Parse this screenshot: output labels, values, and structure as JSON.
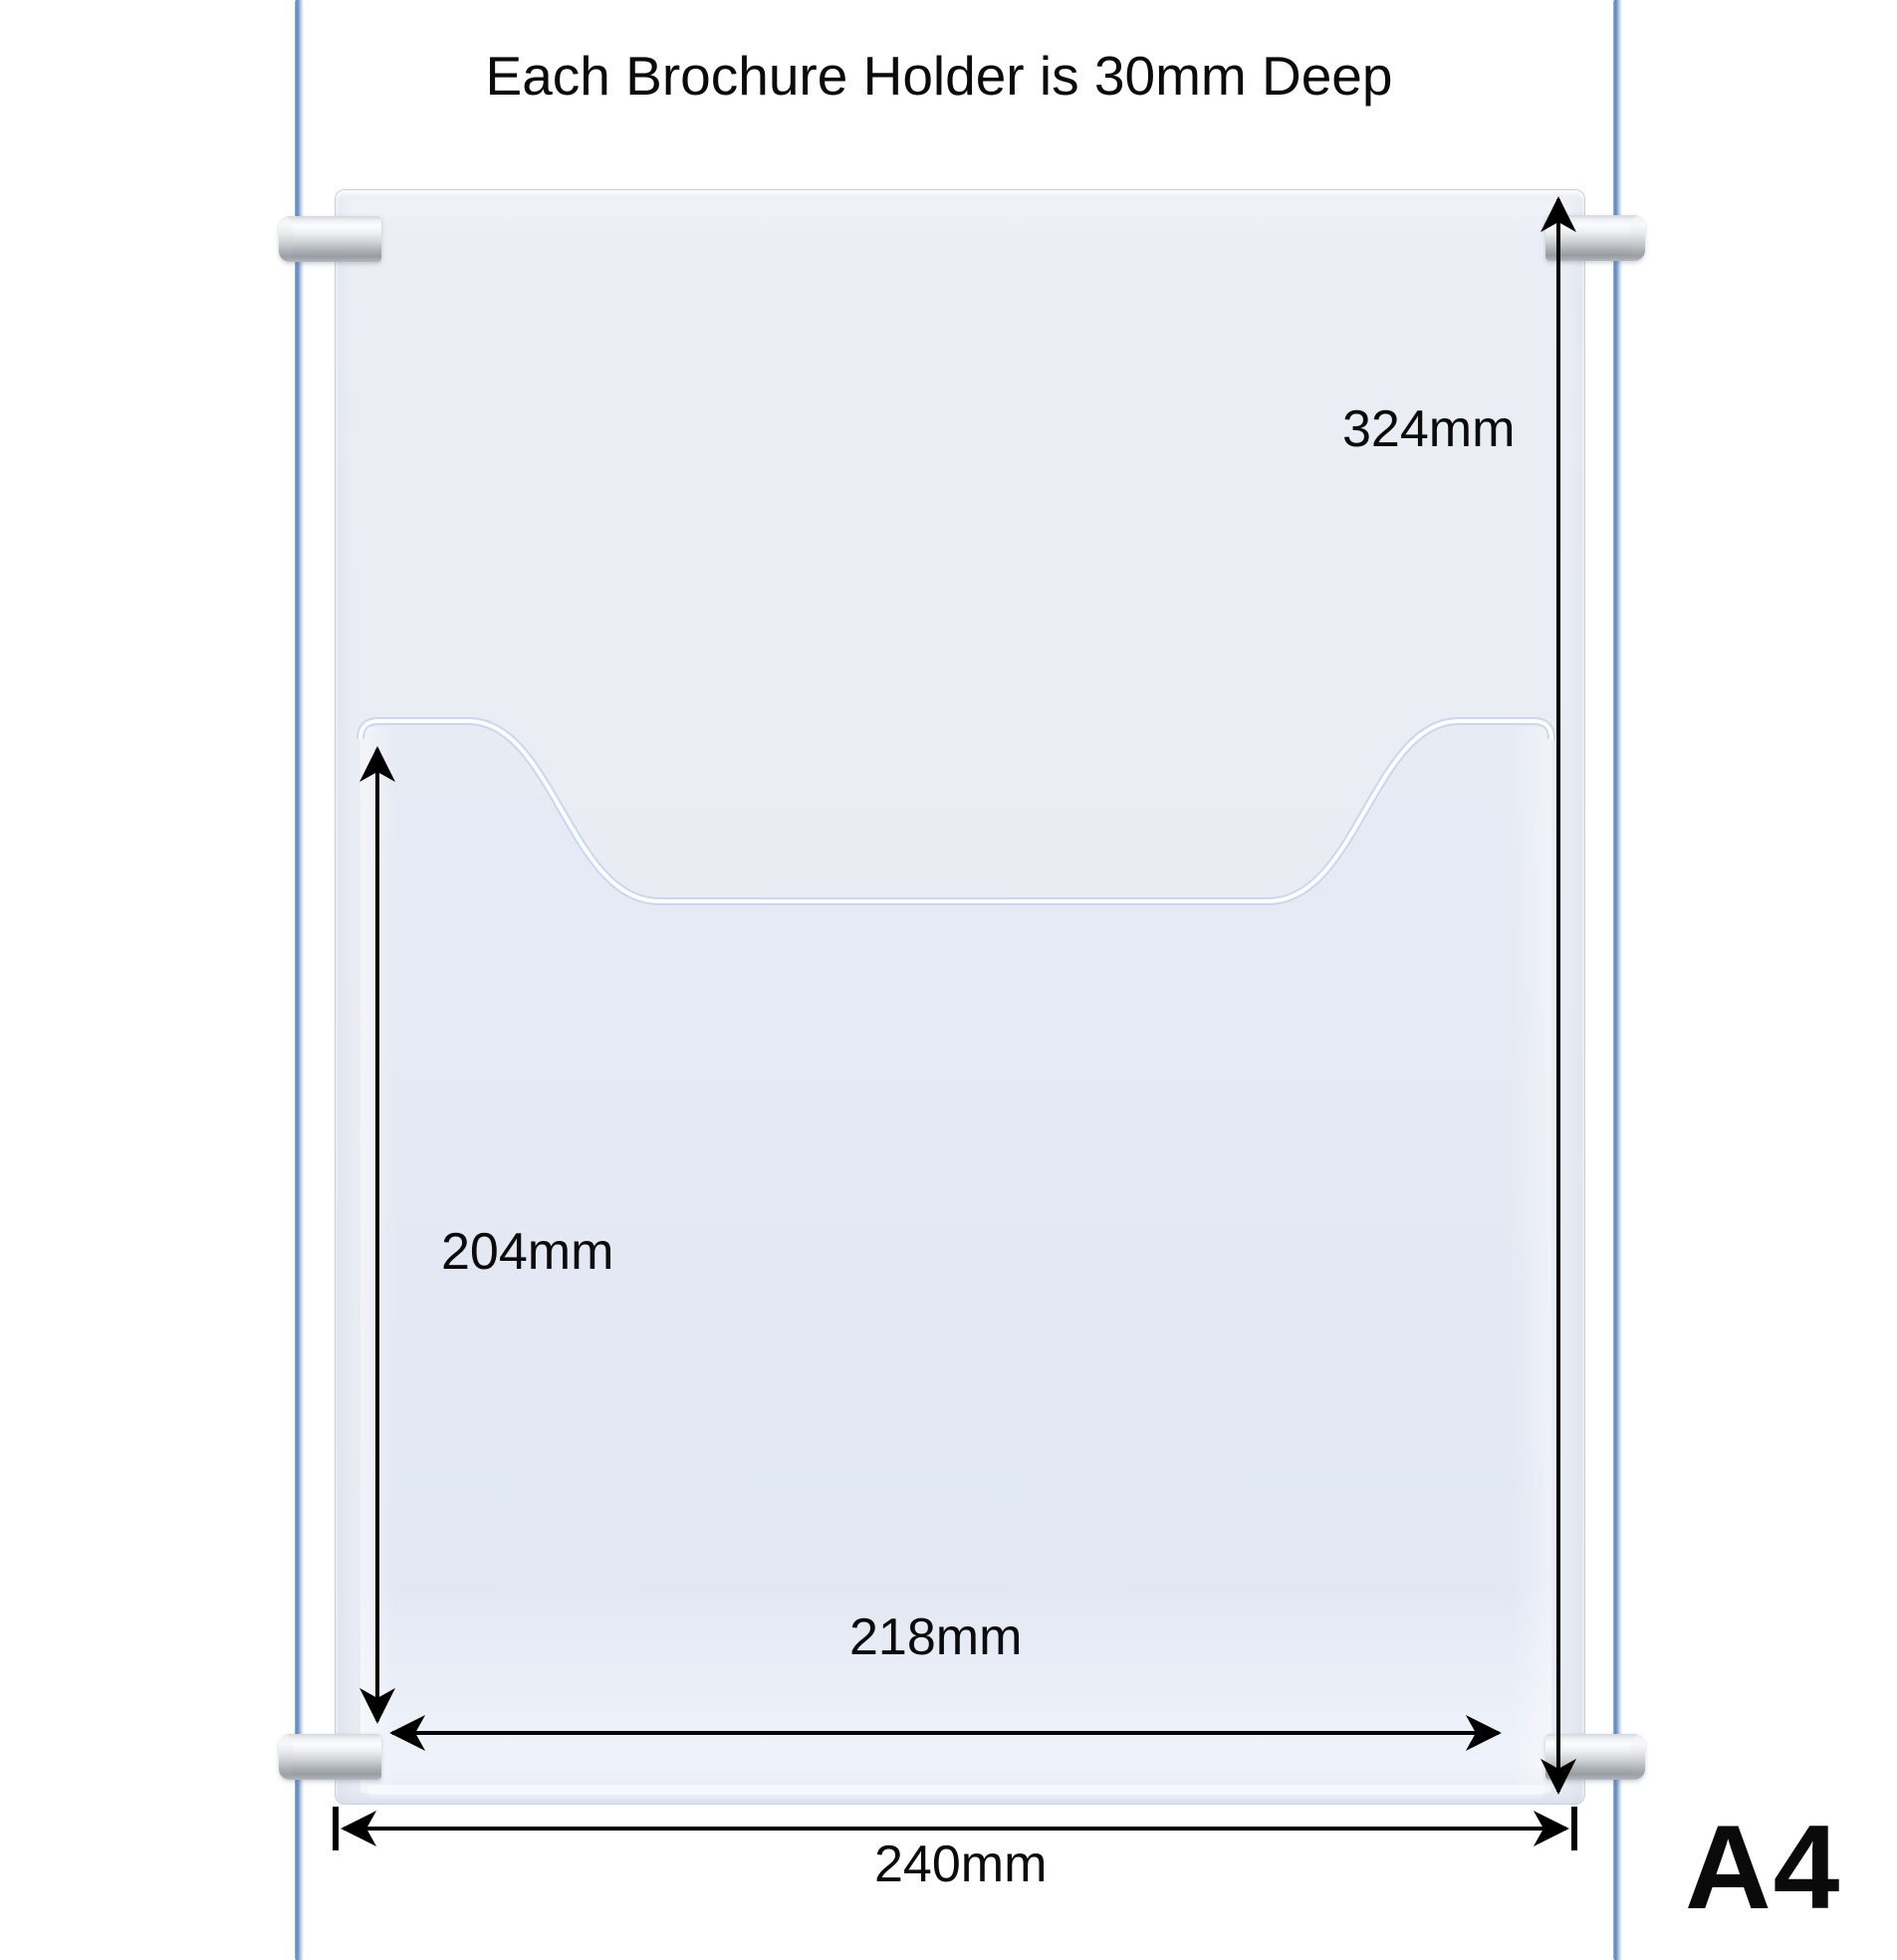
{
  "title": "Each Brochure Holder is 30mm Deep",
  "product": {
    "size_label": "A4"
  },
  "dimensions": {
    "panel_height": "324mm",
    "pocket_height": "204mm",
    "pocket_width": "218mm",
    "panel_width": "240mm"
  },
  "colors": {
    "background": "#ffffff",
    "panel_fill": "#e9ecf3",
    "pocket_fill": "#e3e8f3",
    "pocket_lip_highlight": "#fdfeff",
    "cable_dark": "#5d87bb",
    "cable_light": "#f6f9fd",
    "gripper_silver_light": "#fbfcfd",
    "gripper_silver_dark": "#989da3",
    "dimension_line": "#000000",
    "text": "#0b0b0b"
  }
}
